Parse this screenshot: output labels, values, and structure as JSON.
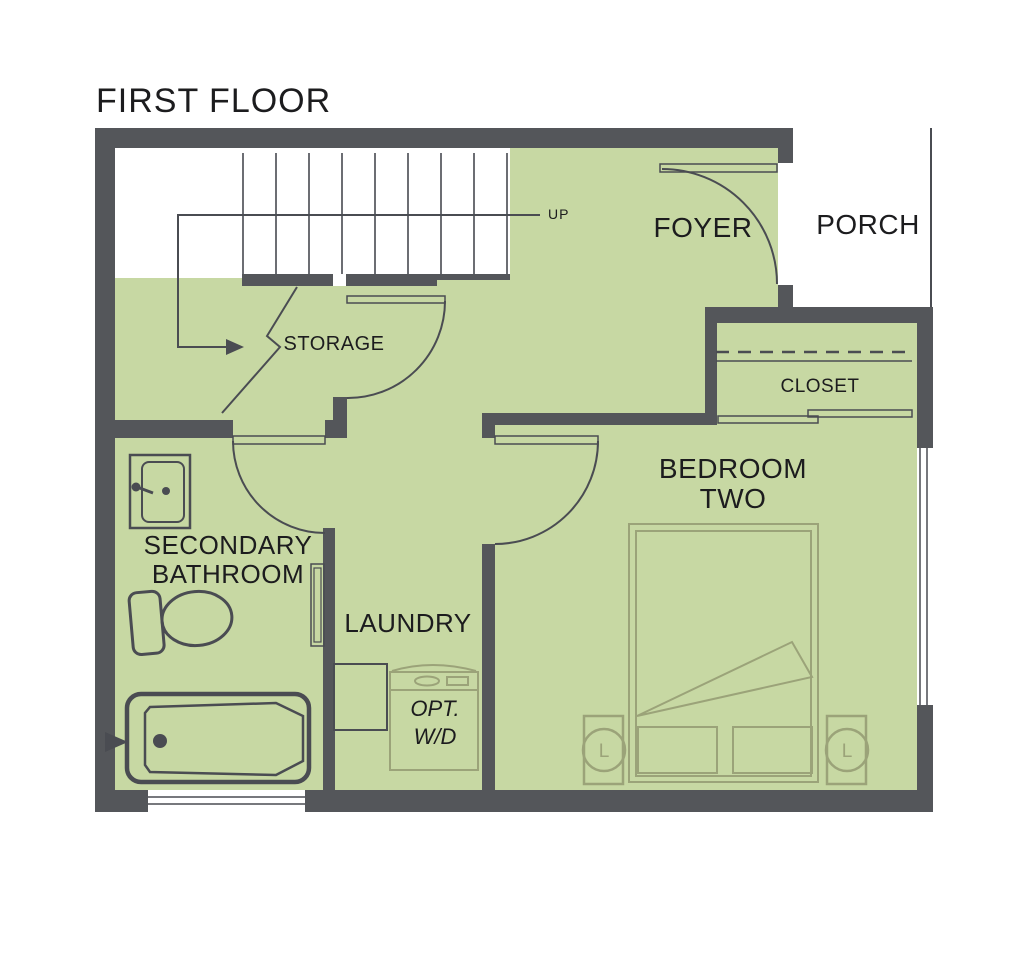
{
  "title": "FIRST FLOOR",
  "colors": {
    "wall": "#54565a",
    "floor": "#c7d8a3",
    "line": "#4a4c52",
    "furniture": "#9ba379",
    "stair-line": "#5c5e64",
    "text": "#1c1c1e"
  },
  "labels": {
    "up": "UP",
    "foyer": "FOYER",
    "porch": "PORCH",
    "storage": "STORAGE",
    "closet": "CLOSET",
    "bedroom_line1": "BEDROOM",
    "bedroom_line2": "TWO",
    "bathroom_line1": "SECONDARY",
    "bathroom_line2": "BATHROOM",
    "laundry": "LAUNDRY",
    "optwd_line1": "OPT.",
    "optwd_line2": "W/D",
    "lamp": "L"
  }
}
